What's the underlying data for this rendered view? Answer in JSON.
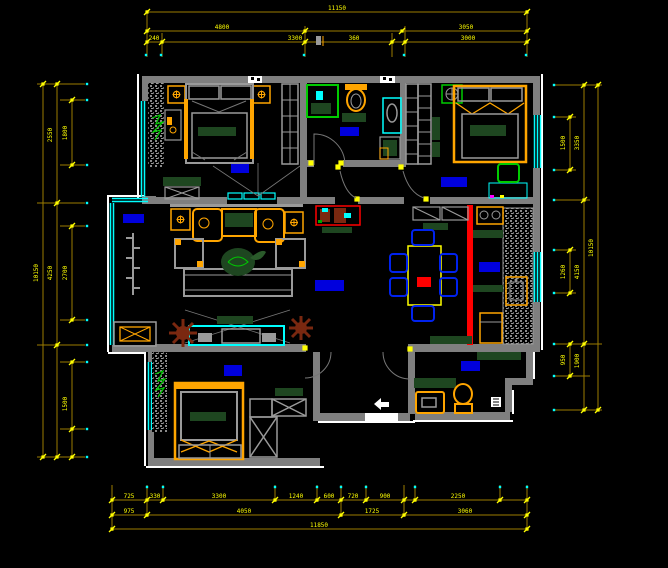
{
  "app": {
    "type": "cad-floor-plan-screenshot",
    "background": "#000000",
    "canvas": {
      "width": 668,
      "height": 568
    }
  },
  "colors": {
    "wall": "#7f7f7f",
    "exterior_trim": "#ffffff",
    "window": "#00ffff",
    "dimension_line": "#9c7c00",
    "dimension_text": "#ffff00",
    "furniture_outline": "#ffa500",
    "upholstery_green": "#1e4620",
    "accent_wall_red": "#ff0000",
    "room_label_block": "#0000dd",
    "fixture_green": "#00cc00",
    "plant_brown": "#7a2810",
    "dining_chair_blue": "#0022ee"
  },
  "rooms": [
    {
      "name": "master-bedroom"
    },
    {
      "name": "bathroom"
    },
    {
      "name": "bedroom-2"
    },
    {
      "name": "balcony"
    },
    {
      "name": "living-room"
    },
    {
      "name": "dining-room"
    },
    {
      "name": "kitchen"
    },
    {
      "name": "bedroom-3"
    },
    {
      "name": "guest-bathroom"
    },
    {
      "name": "entry-hall"
    }
  ],
  "dimensions": {
    "top": {
      "row1": [
        "11150"
      ],
      "row2": [
        "4800",
        "3050"
      ],
      "row3": [
        "240",
        "3300",
        "360",
        "3000"
      ]
    },
    "bottom": {
      "row1": [
        "725",
        "330",
        "3300",
        "1240",
        "600",
        "720",
        "900",
        "2250"
      ],
      "row2": [
        "975",
        "4050",
        "1725",
        "3060"
      ],
      "row3": [
        "11850"
      ]
    },
    "left": {
      "inner": [
        "1800",
        "2700",
        "1500"
      ],
      "mid": [
        "2550",
        "4250"
      ],
      "total": [
        "10150"
      ]
    },
    "right": {
      "inner": [
        "1500",
        "1260",
        "950"
      ],
      "mid": [
        "3350",
        "4150",
        "1900"
      ],
      "total": [
        "10150"
      ]
    }
  }
}
